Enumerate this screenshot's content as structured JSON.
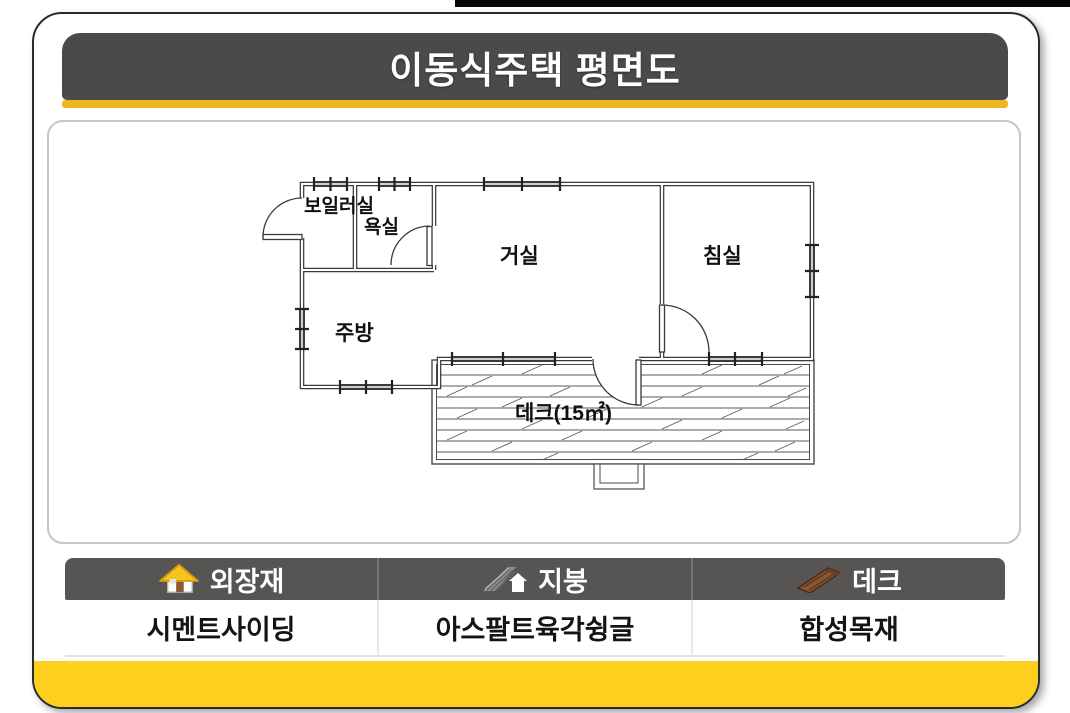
{
  "page": {
    "title": "이동식주택 평면도"
  },
  "colors": {
    "header_bg": "#4a4a48",
    "header_underline": "#eeb622",
    "bottom_bar": "#fdd01e",
    "legend_header_bg": "#565553",
    "plan_wall": "#3a3a3a",
    "house_roof_yellow": "#f5c51e",
    "deck_plank_brown": "#8a5631"
  },
  "floor_plan": {
    "rooms": [
      {
        "name": "boiler-room",
        "label": "보일러실"
      },
      {
        "name": "bathroom",
        "label": "욕실"
      },
      {
        "name": "living-room",
        "label": "거실"
      },
      {
        "name": "bedroom",
        "label": "침실"
      },
      {
        "name": "kitchen",
        "label": "주방"
      },
      {
        "name": "deck",
        "label": "데크(15㎡)",
        "area": "15㎡"
      }
    ]
  },
  "legend": {
    "columns": [
      {
        "icon": "house-icon",
        "label": "외장재",
        "value": "시멘트사이딩"
      },
      {
        "icon": "roof-icon",
        "label": "지붕",
        "value": "아스팔트육각슁글"
      },
      {
        "icon": "deck-plank-icon",
        "label": "데크",
        "value": "합성목재"
      }
    ]
  }
}
